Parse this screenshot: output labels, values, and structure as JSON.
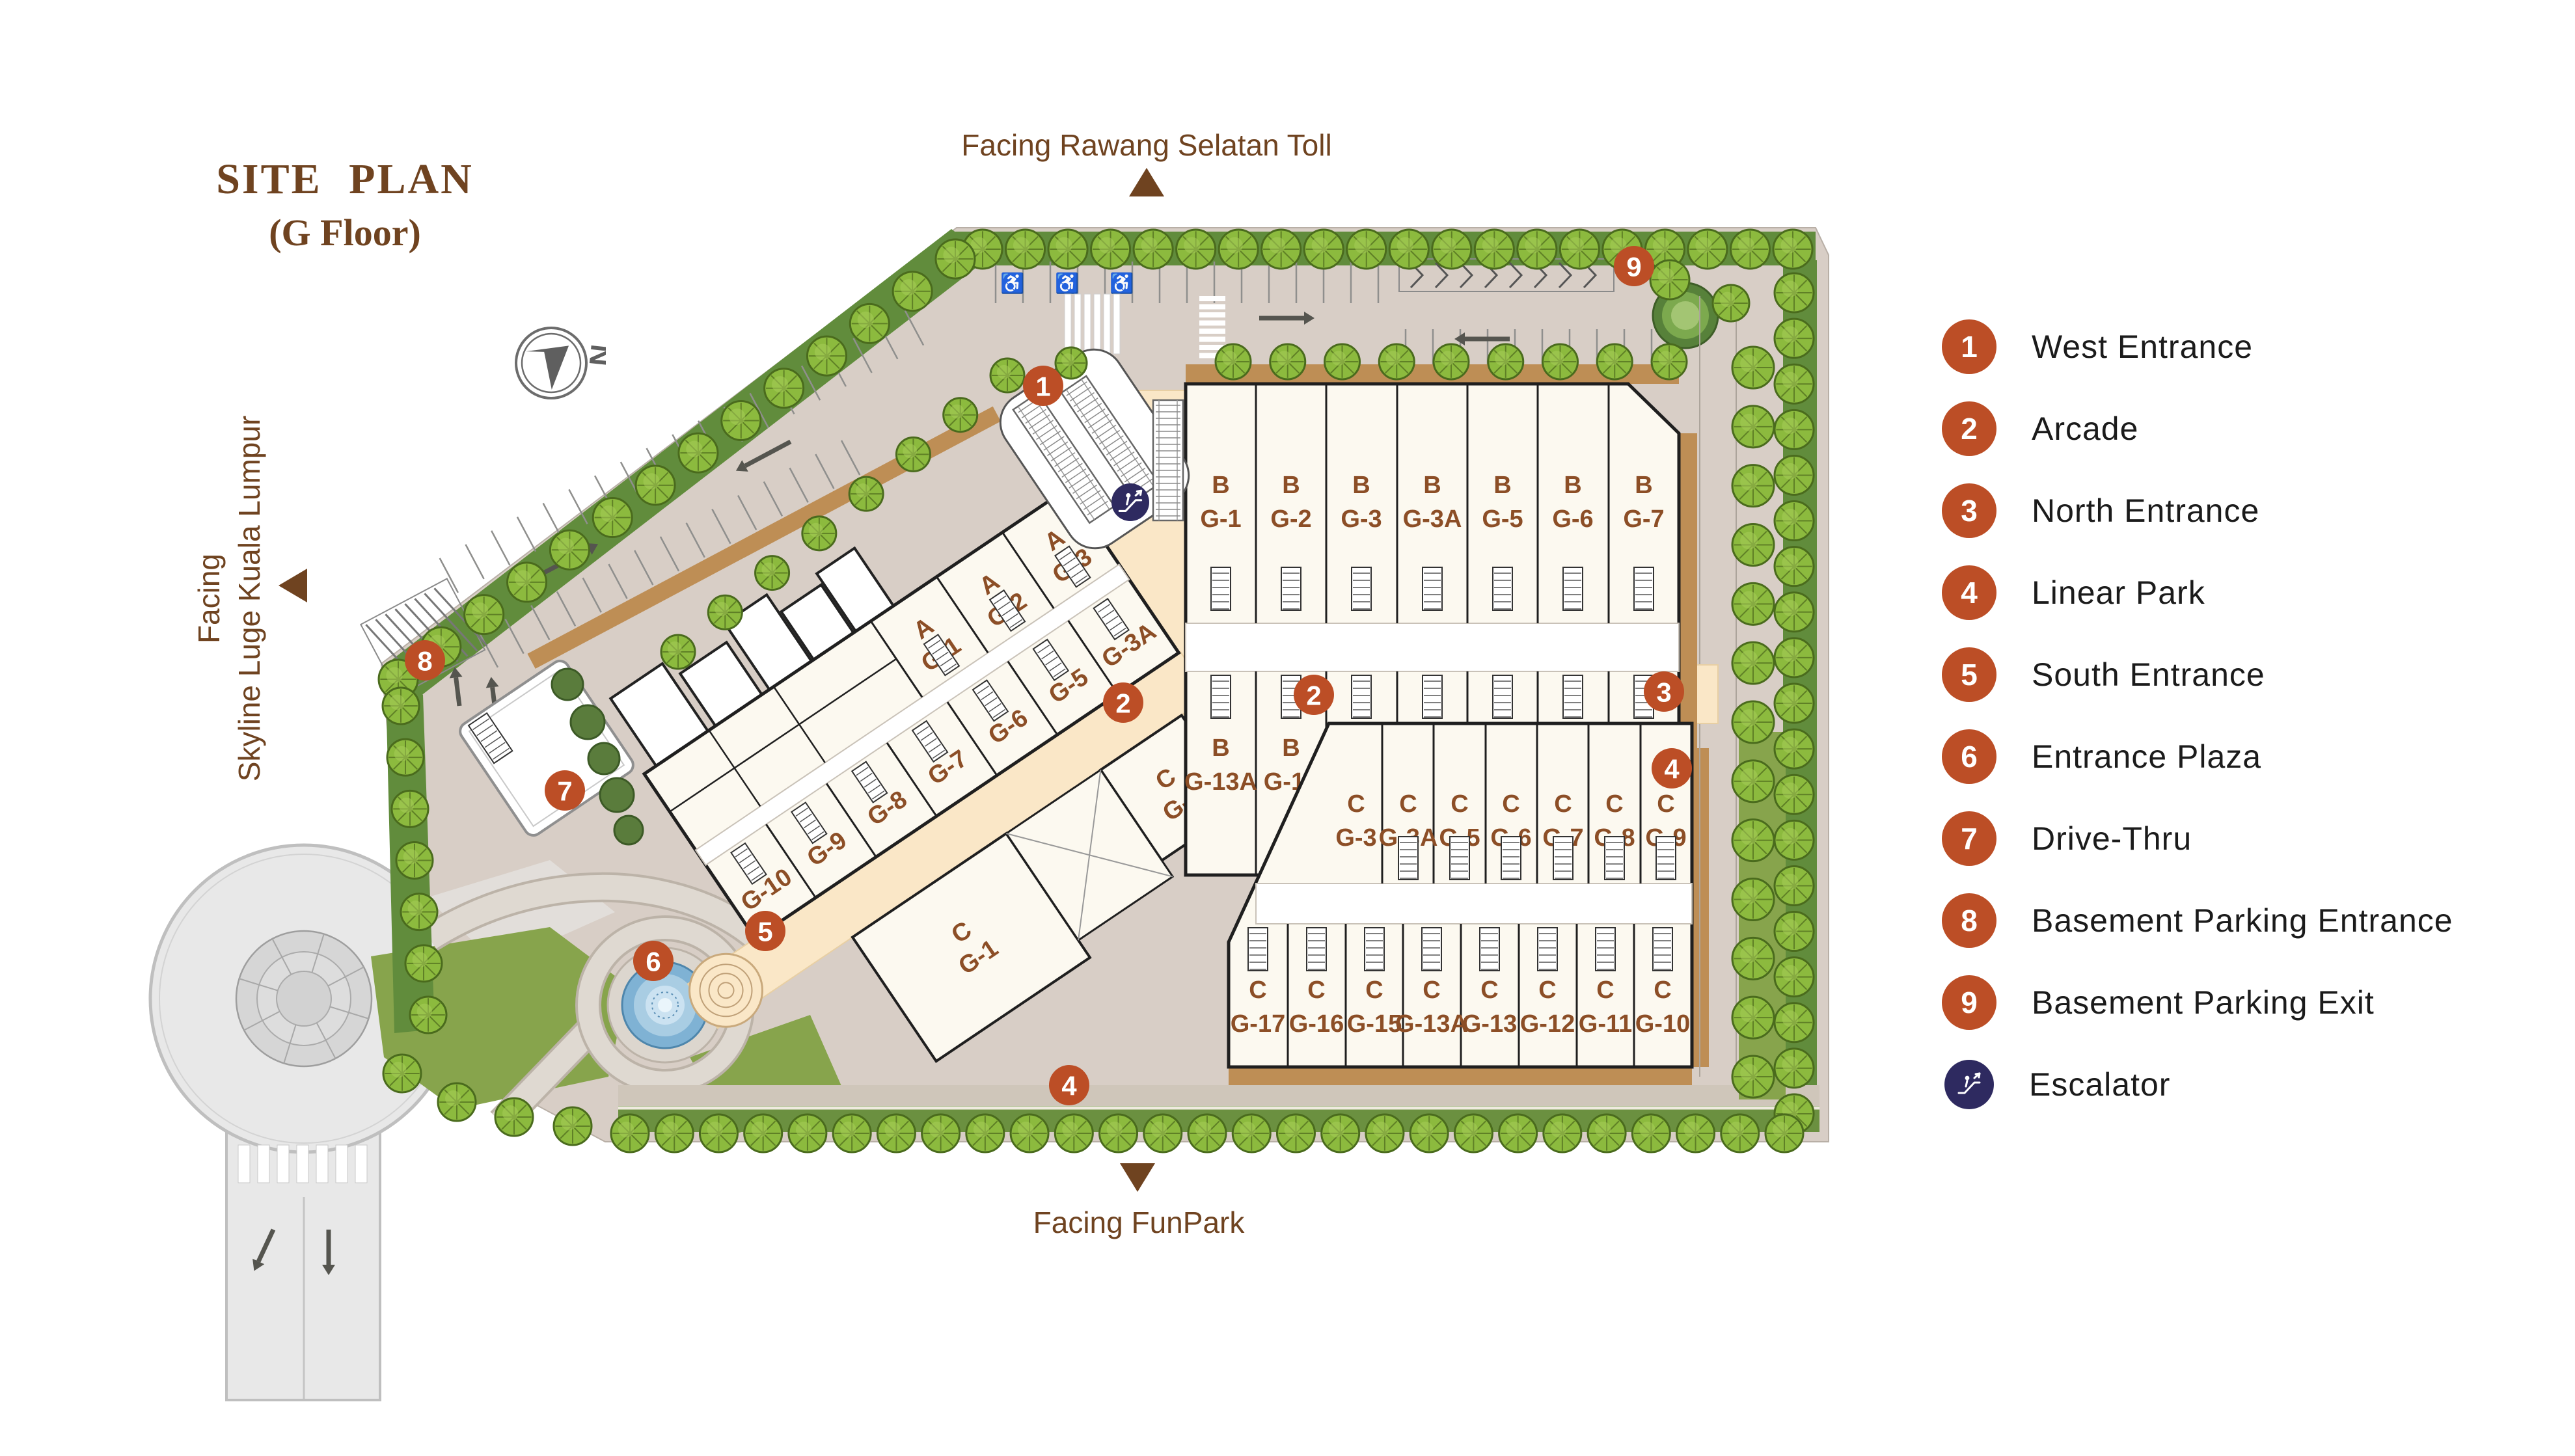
{
  "title": {
    "line1": "SITE PLAN",
    "line2": "(G Floor)"
  },
  "compass": {
    "label": "N"
  },
  "facing": {
    "top": "Facing Rawang Selatan Toll",
    "left_line1": "Facing",
    "left_line2": "Skyline Luge Kuala Lumpur",
    "bottom": "Facing FunPark"
  },
  "legend": {
    "items": [
      {
        "num": "1",
        "label": "West Entrance"
      },
      {
        "num": "2",
        "label": "Arcade"
      },
      {
        "num": "3",
        "label": "North Entrance"
      },
      {
        "num": "4",
        "label": "Linear Park"
      },
      {
        "num": "5",
        "label": "South Entrance"
      },
      {
        "num": "6",
        "label": "Entrance Plaza"
      },
      {
        "num": "7",
        "label": "Drive-Thru"
      },
      {
        "num": "8",
        "label": "Basement Parking Entrance"
      },
      {
        "num": "9",
        "label": "Basement Parking Exit"
      },
      {
        "icon": "escalator",
        "label": "Escalator"
      }
    ]
  },
  "plan": {
    "block_a": {
      "letter": "A",
      "row_nw": [
        "G-1",
        "G-2",
        "G-3"
      ],
      "row_se": [
        "G-10",
        "G-9",
        "G-8",
        "G-7",
        "G-6",
        "G-5",
        "G-3A"
      ]
    },
    "block_b": {
      "letter": "B",
      "row_top": [
        "G-1",
        "G-2",
        "G-3",
        "G-3A",
        "G-5",
        "G-6",
        "G-7"
      ],
      "row_bottom": [
        "G-13A",
        "G-13",
        "G-12",
        "G-11",
        "G-10",
        "G-9",
        "G-8"
      ]
    },
    "block_c": {
      "letter": "C",
      "row_top": [
        "G-3",
        "G-3A",
        "G-5",
        "G-6",
        "G-7",
        "G-8",
        "G-9"
      ],
      "row_bottom": [
        "G-17",
        "G-16",
        "G-15",
        "G-13A",
        "G-13",
        "G-12",
        "G-11",
        "G-10"
      ],
      "annex": [
        "G-2",
        "G-1"
      ]
    },
    "badges": [
      {
        "num": "1",
        "name": "west-entrance"
      },
      {
        "num": "2",
        "name": "arcade-west"
      },
      {
        "num": "2",
        "name": "arcade-east"
      },
      {
        "num": "3",
        "name": "north-entrance"
      },
      {
        "num": "4",
        "name": "linear-park-east"
      },
      {
        "num": "4",
        "name": "linear-park-south"
      },
      {
        "num": "5",
        "name": "south-entrance"
      },
      {
        "num": "6",
        "name": "entrance-plaza"
      },
      {
        "num": "7",
        "name": "drive-thru"
      },
      {
        "num": "8",
        "name": "basement-parking-entrance"
      },
      {
        "num": "9",
        "name": "basement-parking-exit"
      },
      {
        "icon": "escalator",
        "name": "escalator"
      }
    ]
  },
  "colors": {
    "badge": "#BC4E26",
    "navy": "#2E2A60",
    "brown": "#6F4320",
    "unit_label": "#8C4E26",
    "tree": "#8CBA3E",
    "tree_edge": "#4A6B1D",
    "hedge": "#618C3C",
    "lawn": "#87A44C",
    "road": "#D8CEC6",
    "tan": "#BE8E55",
    "building": "#FCF9F0",
    "arcade": "#FAE7C7",
    "water": "#7FB2D4",
    "roundabout": "#E8E8E8"
  }
}
